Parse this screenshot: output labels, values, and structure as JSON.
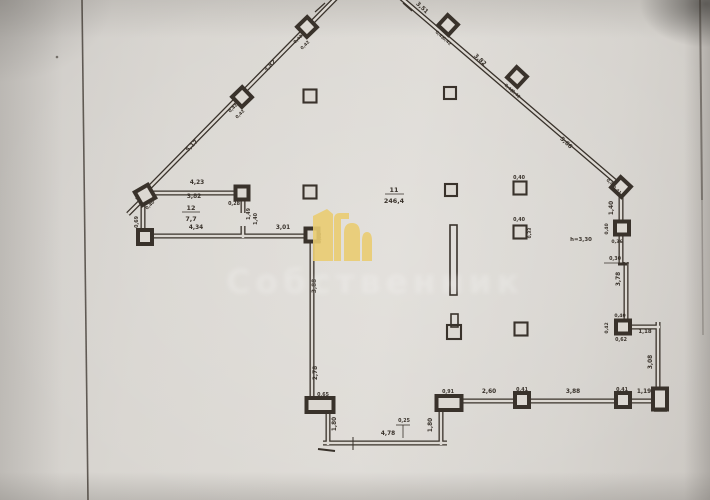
{
  "watermark": {
    "text": "Собственник",
    "logo_color": "#eacd72",
    "text_color": "#ffffff"
  },
  "plan": {
    "ink_color": "#39322b",
    "paper_inner": "#dcd8d2",
    "rooms": [
      {
        "number": "11",
        "area": "246,4"
      },
      {
        "number": "12",
        "area": "7,7"
      }
    ],
    "height_note": "h=3,30",
    "walls": [
      {
        "x1": 137,
        "y1": 200,
        "x2": 337,
        "y2": -3
      },
      {
        "x1": 400,
        "y1": -3,
        "x2": 622,
        "y2": 187
      },
      {
        "x1": 621,
        "y1": 184,
        "x2": 621,
        "y2": 264
      },
      {
        "x1": 626,
        "y1": 262,
        "x2": 626,
        "y2": 326
      },
      {
        "x1": 619,
        "y1": 327,
        "x2": 660,
        "y2": 327
      },
      {
        "x1": 658,
        "y1": 322,
        "x2": 658,
        "y2": 401
      },
      {
        "x1": 661,
        "y1": 401,
        "x2": 448,
        "y2": 401
      },
      {
        "x1": 441,
        "y1": 404,
        "x2": 441,
        "y2": 445
      },
      {
        "x1": 447,
        "y1": 443,
        "x2": 323,
        "y2": 443
      },
      {
        "x1": 328,
        "y1": 445,
        "x2": 328,
        "y2": 407
      },
      {
        "x1": 312,
        "y1": 401,
        "x2": 312,
        "y2": 234
      },
      {
        "x1": 315,
        "y1": 236,
        "x2": 139,
        "y2": 236
      },
      {
        "x1": 143,
        "y1": 238,
        "x2": 143,
        "y2": 196
      },
      {
        "x1": 140,
        "y1": 193,
        "x2": 245,
        "y2": 193
      },
      {
        "x1": 243,
        "y1": 192,
        "x2": 243,
        "y2": 213
      },
      {
        "x1": 243,
        "y1": 226,
        "x2": 243,
        "y2": 238
      },
      {
        "x1": 144,
        "y1": 198,
        "x2": 128,
        "y2": 214
      }
    ],
    "piers": [
      {
        "x": 307,
        "y": 27,
        "w": 14,
        "h": 14,
        "r": -44
      },
      {
        "x": 242,
        "y": 97,
        "w": 14,
        "h": 14,
        "r": -44
      },
      {
        "x": 145,
        "y": 195,
        "w": 15,
        "h": 15,
        "r": -30
      },
      {
        "x": 448,
        "y": 25,
        "w": 14,
        "h": 14,
        "r": 43
      },
      {
        "x": 517,
        "y": 77,
        "w": 14,
        "h": 14,
        "r": 43
      },
      {
        "x": 621,
        "y": 187,
        "w": 14,
        "h": 14,
        "r": 43
      },
      {
        "x": 242,
        "y": 193,
        "w": 13,
        "h": 13,
        "r": 0
      },
      {
        "x": 145,
        "y": 237,
        "w": 14,
        "h": 14,
        "r": 0
      },
      {
        "x": 312,
        "y": 235,
        "w": 13,
        "h": 13,
        "r": 0
      },
      {
        "x": 622,
        "y": 228,
        "w": 14,
        "h": 13,
        "r": 0
      },
      {
        "x": 623,
        "y": 327,
        "w": 14,
        "h": 13,
        "r": 0
      },
      {
        "x": 660,
        "y": 399,
        "w": 14,
        "h": 21,
        "r": 0
      },
      {
        "x": 522,
        "y": 400,
        "w": 14,
        "h": 14,
        "r": 0
      },
      {
        "x": 623,
        "y": 400,
        "w": 14,
        "h": 14,
        "r": 0
      },
      {
        "x": 320,
        "y": 405,
        "w": 27,
        "h": 14,
        "r": 0
      },
      {
        "x": 449,
        "y": 403,
        "w": 25,
        "h": 14,
        "r": 0
      }
    ],
    "columns": [
      {
        "x": 310,
        "y": 96,
        "s": 13
      },
      {
        "x": 450,
        "y": 93,
        "s": 12
      },
      {
        "x": 310,
        "y": 192,
        "s": 13
      },
      {
        "x": 451,
        "y": 190,
        "s": 12
      },
      {
        "x": 520,
        "y": 188,
        "s": 13
      },
      {
        "x": 520,
        "y": 232,
        "s": 13
      },
      {
        "x": 521,
        "y": 329,
        "s": 13
      },
      {
        "x": 454,
        "y": 332,
        "s": 14
      }
    ],
    "rects": [
      {
        "x": 450,
        "y": 225,
        "w": 7,
        "h": 70
      },
      {
        "x": 451,
        "y": 314,
        "w": 7,
        "h": 13
      }
    ],
    "lines": [
      {
        "x1": 385,
        "y1": 194,
        "x2": 404,
        "y2": 194,
        "w": 0.8
      },
      {
        "x1": 182,
        "y1": 212,
        "x2": 200,
        "y2": 212,
        "w": 0.8
      },
      {
        "x1": 604,
        "y1": 263,
        "x2": 629,
        "y2": 263,
        "w": 0.8
      },
      {
        "x1": 618,
        "y1": 264,
        "x2": 627,
        "y2": 264,
        "w": 3
      },
      {
        "x1": 396,
        "y1": 425,
        "x2": 410,
        "y2": 425,
        "w": 0.8
      },
      {
        "x1": 403,
        "y1": 425,
        "x2": 403,
        "y2": 438,
        "w": 0.8
      },
      {
        "x1": 316,
        "y1": 399,
        "x2": 330,
        "y2": 399,
        "w": 0.8
      },
      {
        "x1": 353,
        "y1": 437,
        "x2": 353,
        "y2": 450,
        "w": 1
      },
      {
        "x1": 318,
        "y1": 449,
        "x2": 335,
        "y2": 451,
        "w": 2
      },
      {
        "x1": 654,
        "y1": 411,
        "x2": 667,
        "y2": 411,
        "w": 1.5
      },
      {
        "x1": 315,
        "y1": 12,
        "x2": 325,
        "y2": 3,
        "w": 1.2
      },
      {
        "x1": 403,
        "y1": 3,
        "x2": 412,
        "y2": 11,
        "w": 1.2
      },
      {
        "x1": 82,
        "y1": 0,
        "x2": 88,
        "y2": 500,
        "w": 1.6,
        "o": 0.75
      },
      {
        "x1": 700,
        "y1": 0,
        "x2": 702,
        "y2": 200,
        "w": 2,
        "o": 0.5
      },
      {
        "x1": 702,
        "y1": 200,
        "x2": 703,
        "y2": 335,
        "w": 1.5,
        "o": 0.28
      }
    ],
    "dots": [
      {
        "x": 57,
        "y": 57,
        "r": 1.3
      }
    ],
    "labels": [
      {
        "t": "5,17",
        "x": 193,
        "y": 147,
        "r": -44
      },
      {
        "t": "3,82",
        "x": 271,
        "y": 67,
        "r": -44
      },
      {
        "t": "0,42",
        "x": 299,
        "y": 40,
        "r": -44,
        "fs": 4.3
      },
      {
        "t": "0,42",
        "x": 306,
        "y": 46,
        "r": -44,
        "fs": 4.3
      },
      {
        "t": "0,42",
        "x": 234,
        "y": 109,
        "r": -44,
        "fs": 4.3
      },
      {
        "t": "0,42",
        "x": 241,
        "y": 115,
        "r": -44,
        "fs": 4.3
      },
      {
        "t": "0,40",
        "x": 151,
        "y": 206,
        "r": -44,
        "fs": 4.3
      },
      {
        "t": "3,51",
        "x": 421,
        "y": 9,
        "r": 43
      },
      {
        "t": "0,42",
        "x": 439,
        "y": 36,
        "r": 43,
        "fs": 4.3
      },
      {
        "t": "0,42",
        "x": 446,
        "y": 42,
        "r": 43,
        "fs": 4.3
      },
      {
        "t": "3,82",
        "x": 479,
        "y": 61,
        "r": 43
      },
      {
        "t": "0,42",
        "x": 508,
        "y": 89,
        "r": 43,
        "fs": 4.3
      },
      {
        "t": "0,42",
        "x": 515,
        "y": 95,
        "r": 43,
        "fs": 4.3
      },
      {
        "t": "5,66",
        "x": 565,
        "y": 144,
        "r": 43
      },
      {
        "t": "0,41",
        "x": 610,
        "y": 184,
        "r": 43,
        "fs": 4.3
      },
      {
        "t": "0,41",
        "x": 616,
        "y": 191,
        "r": 43,
        "fs": 4.3
      },
      {
        "t": "1,40",
        "x": 613,
        "y": 208,
        "r": -90
      },
      {
        "t": "0,40",
        "x": 608,
        "y": 229,
        "r": -90,
        "fs": 4.6
      },
      {
        "t": "0,36",
        "x": 617,
        "y": 243,
        "fs": 4.6
      },
      {
        "t": "h=3,30",
        "x": 581,
        "y": 241,
        "fs": 5.4
      },
      {
        "t": "0,30",
        "x": 615,
        "y": 260,
        "fs": 4.8
      },
      {
        "t": "3,78",
        "x": 620,
        "y": 279,
        "r": -90
      },
      {
        "t": "0,40",
        "x": 620,
        "y": 317,
        "fs": 4.6
      },
      {
        "t": "0,42",
        "x": 608,
        "y": 328,
        "r": -90,
        "fs": 4.6
      },
      {
        "t": "0,62",
        "x": 621,
        "y": 341,
        "fs": 4.8
      },
      {
        "t": "1,18",
        "x": 645,
        "y": 333,
        "fs": 5.4
      },
      {
        "t": "3,08",
        "x": 652,
        "y": 362,
        "r": -90
      },
      {
        "t": "1,19",
        "x": 644,
        "y": 393
      },
      {
        "t": "0,41",
        "x": 622,
        "y": 391,
        "fs": 4.8
      },
      {
        "t": "3,88",
        "x": 573,
        "y": 393
      },
      {
        "t": "0,41",
        "x": 522,
        "y": 391,
        "fs": 4.8
      },
      {
        "t": "2,60",
        "x": 489,
        "y": 393
      },
      {
        "t": "0,91",
        "x": 448,
        "y": 393,
        "fs": 4.8
      },
      {
        "t": "1,80",
        "x": 432,
        "y": 425,
        "r": -90
      },
      {
        "t": "0,25",
        "x": 404,
        "y": 422,
        "fs": 4.8
      },
      {
        "t": "4,78",
        "x": 388,
        "y": 435
      },
      {
        "t": "1,80",
        "x": 336,
        "y": 424,
        "r": -90
      },
      {
        "t": "0,65",
        "x": 323,
        "y": 396,
        "fs": 4.8
      },
      {
        "t": "2,78",
        "x": 317,
        "y": 373,
        "r": -90
      },
      {
        "t": "3,88",
        "x": 316,
        "y": 286,
        "r": -90
      },
      {
        "t": "0,52",
        "x": 321,
        "y": 238,
        "r": -90,
        "fs": 4.3
      },
      {
        "t": "3,01",
        "x": 283,
        "y": 229
      },
      {
        "t": "4,34",
        "x": 196,
        "y": 229
      },
      {
        "t": "0,69",
        "x": 138,
        "y": 222,
        "r": -90,
        "fs": 4.8
      },
      {
        "t": "4,23",
        "x": 197,
        "y": 184
      },
      {
        "t": "3,82",
        "x": 194,
        "y": 198
      },
      {
        "t": "0,28",
        "x": 234,
        "y": 205,
        "fs": 4.8
      },
      {
        "t": "1,49",
        "x": 250,
        "y": 214,
        "r": -90,
        "fs": 4.8
      },
      {
        "t": "1,40",
        "x": 257,
        "y": 219,
        "r": -90,
        "fs": 4.8
      },
      {
        "t": "0,40",
        "x": 519,
        "y": 179,
        "fs": 4.8
      },
      {
        "t": "0,40",
        "x": 519,
        "y": 221,
        "fs": 4.8
      },
      {
        "t": "0,33",
        "x": 531,
        "y": 233,
        "r": -90,
        "fs": 4.3
      },
      {
        "t": "11",
        "x": 394,
        "y": 192,
        "fs": 6.4
      },
      {
        "t": "246,4",
        "x": 394,
        "y": 203,
        "fs": 6.4
      },
      {
        "t": "12",
        "x": 191,
        "y": 210,
        "fs": 6.4
      },
      {
        "t": "7,7",
        "x": 191,
        "y": 221,
        "fs": 6.4
      }
    ]
  }
}
